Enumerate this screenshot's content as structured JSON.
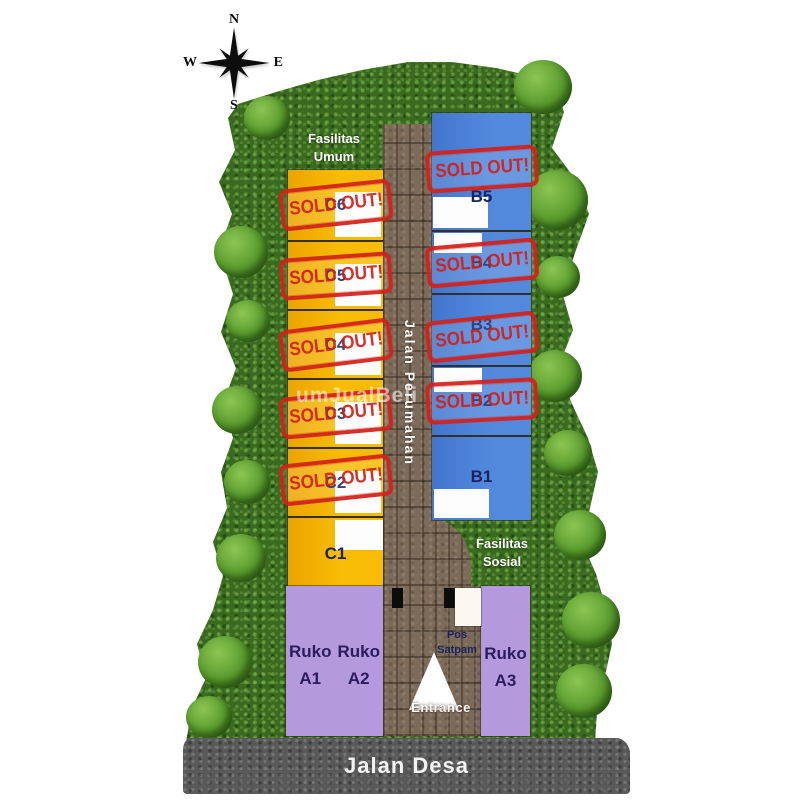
{
  "compass": {
    "north": "N",
    "east": "E",
    "south": "S",
    "west": "W"
  },
  "areas": {
    "fasilitas_umum_line1": "Fasilitas",
    "fasilitas_umum_line2": "Umum",
    "fasilitas_sosial_line1": "Fasilitas",
    "fasilitas_sosial_line2": "Sosial",
    "jalan_perumahan": "Jalan Perumahan",
    "jalan_desa": "Jalan Desa",
    "pos_satpam_line1": "Pos",
    "pos_satpam_line2": "Satpam",
    "entrance": "Entrance",
    "watermark": "umJualBeli"
  },
  "stamp": {
    "text": "SOLD OUT!"
  },
  "units": {
    "c": [
      {
        "label": "C6",
        "status": "sold-out"
      },
      {
        "label": "C5",
        "status": "sold-out"
      },
      {
        "label": "C4",
        "status": "sold-out"
      },
      {
        "label": "C3",
        "status": "sold-out"
      },
      {
        "label": "C2",
        "status": "sold-out"
      },
      {
        "label": "C1",
        "status": "available"
      }
    ],
    "b": [
      {
        "label": "B5",
        "status": "sold-out"
      },
      {
        "label": "B4",
        "status": "sold-out"
      },
      {
        "label": "B3",
        "status": "sold-out"
      },
      {
        "label": "B2",
        "status": "sold-out"
      },
      {
        "label": "B1",
        "status": "available"
      }
    ],
    "ruko": [
      {
        "line1": "Ruko",
        "line2": "A1"
      },
      {
        "line1": "Ruko",
        "line2": "A2"
      },
      {
        "line1": "Ruko",
        "line2": "A3"
      }
    ]
  },
  "colors": {
    "lot_yellow": "#F5B400",
    "lot_blue": "#4B82D9",
    "lot_purple": "#B49ADD",
    "stamp_red": "#D2221B",
    "label_navy": "#1A2360",
    "road_brown": "#7D6B59",
    "asphalt_gray": "#595959",
    "hedge_green": "#3A6A1F"
  }
}
